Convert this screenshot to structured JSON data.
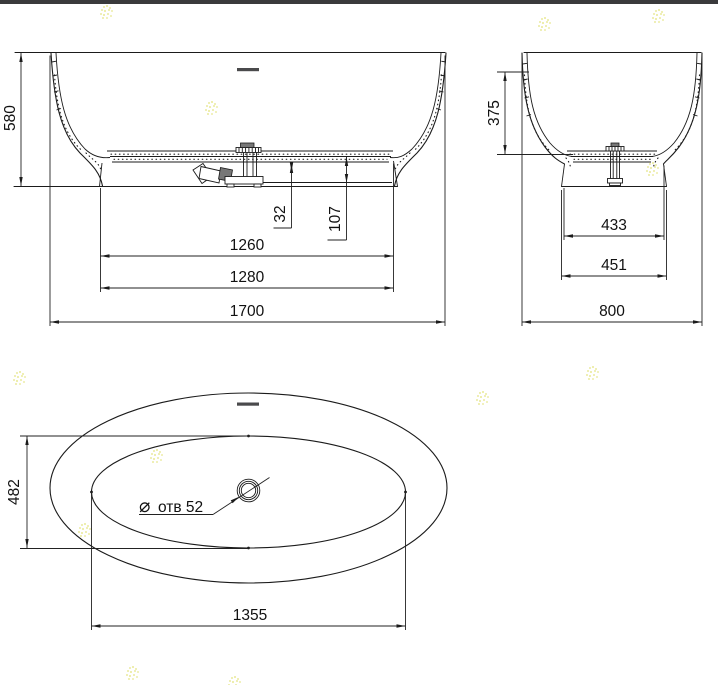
{
  "window": {
    "top_bar_color": "#3a3a3c",
    "background": "#ffffff"
  },
  "drawing": {
    "line_color": "#1b1b1b",
    "watermark_color": "#e0e06e",
    "views": {
      "front": {
        "dimensions": {
          "overall_height": "580",
          "overflow_gap": "32",
          "drain_offset": "107",
          "base_top_length": "1260",
          "base_bottom_length": "1280",
          "overall_length": "1700"
        }
      },
      "side": {
        "dimensions": {
          "inner_depth": "375",
          "base_top_width": "433",
          "base_bottom_width": "451",
          "overall_width": "800"
        }
      },
      "plan": {
        "dimensions": {
          "inner_width": "482",
          "inner_length": "1355"
        },
        "drain_label": {
          "symbol": "⌀",
          "text": "отв 52"
        }
      }
    }
  }
}
